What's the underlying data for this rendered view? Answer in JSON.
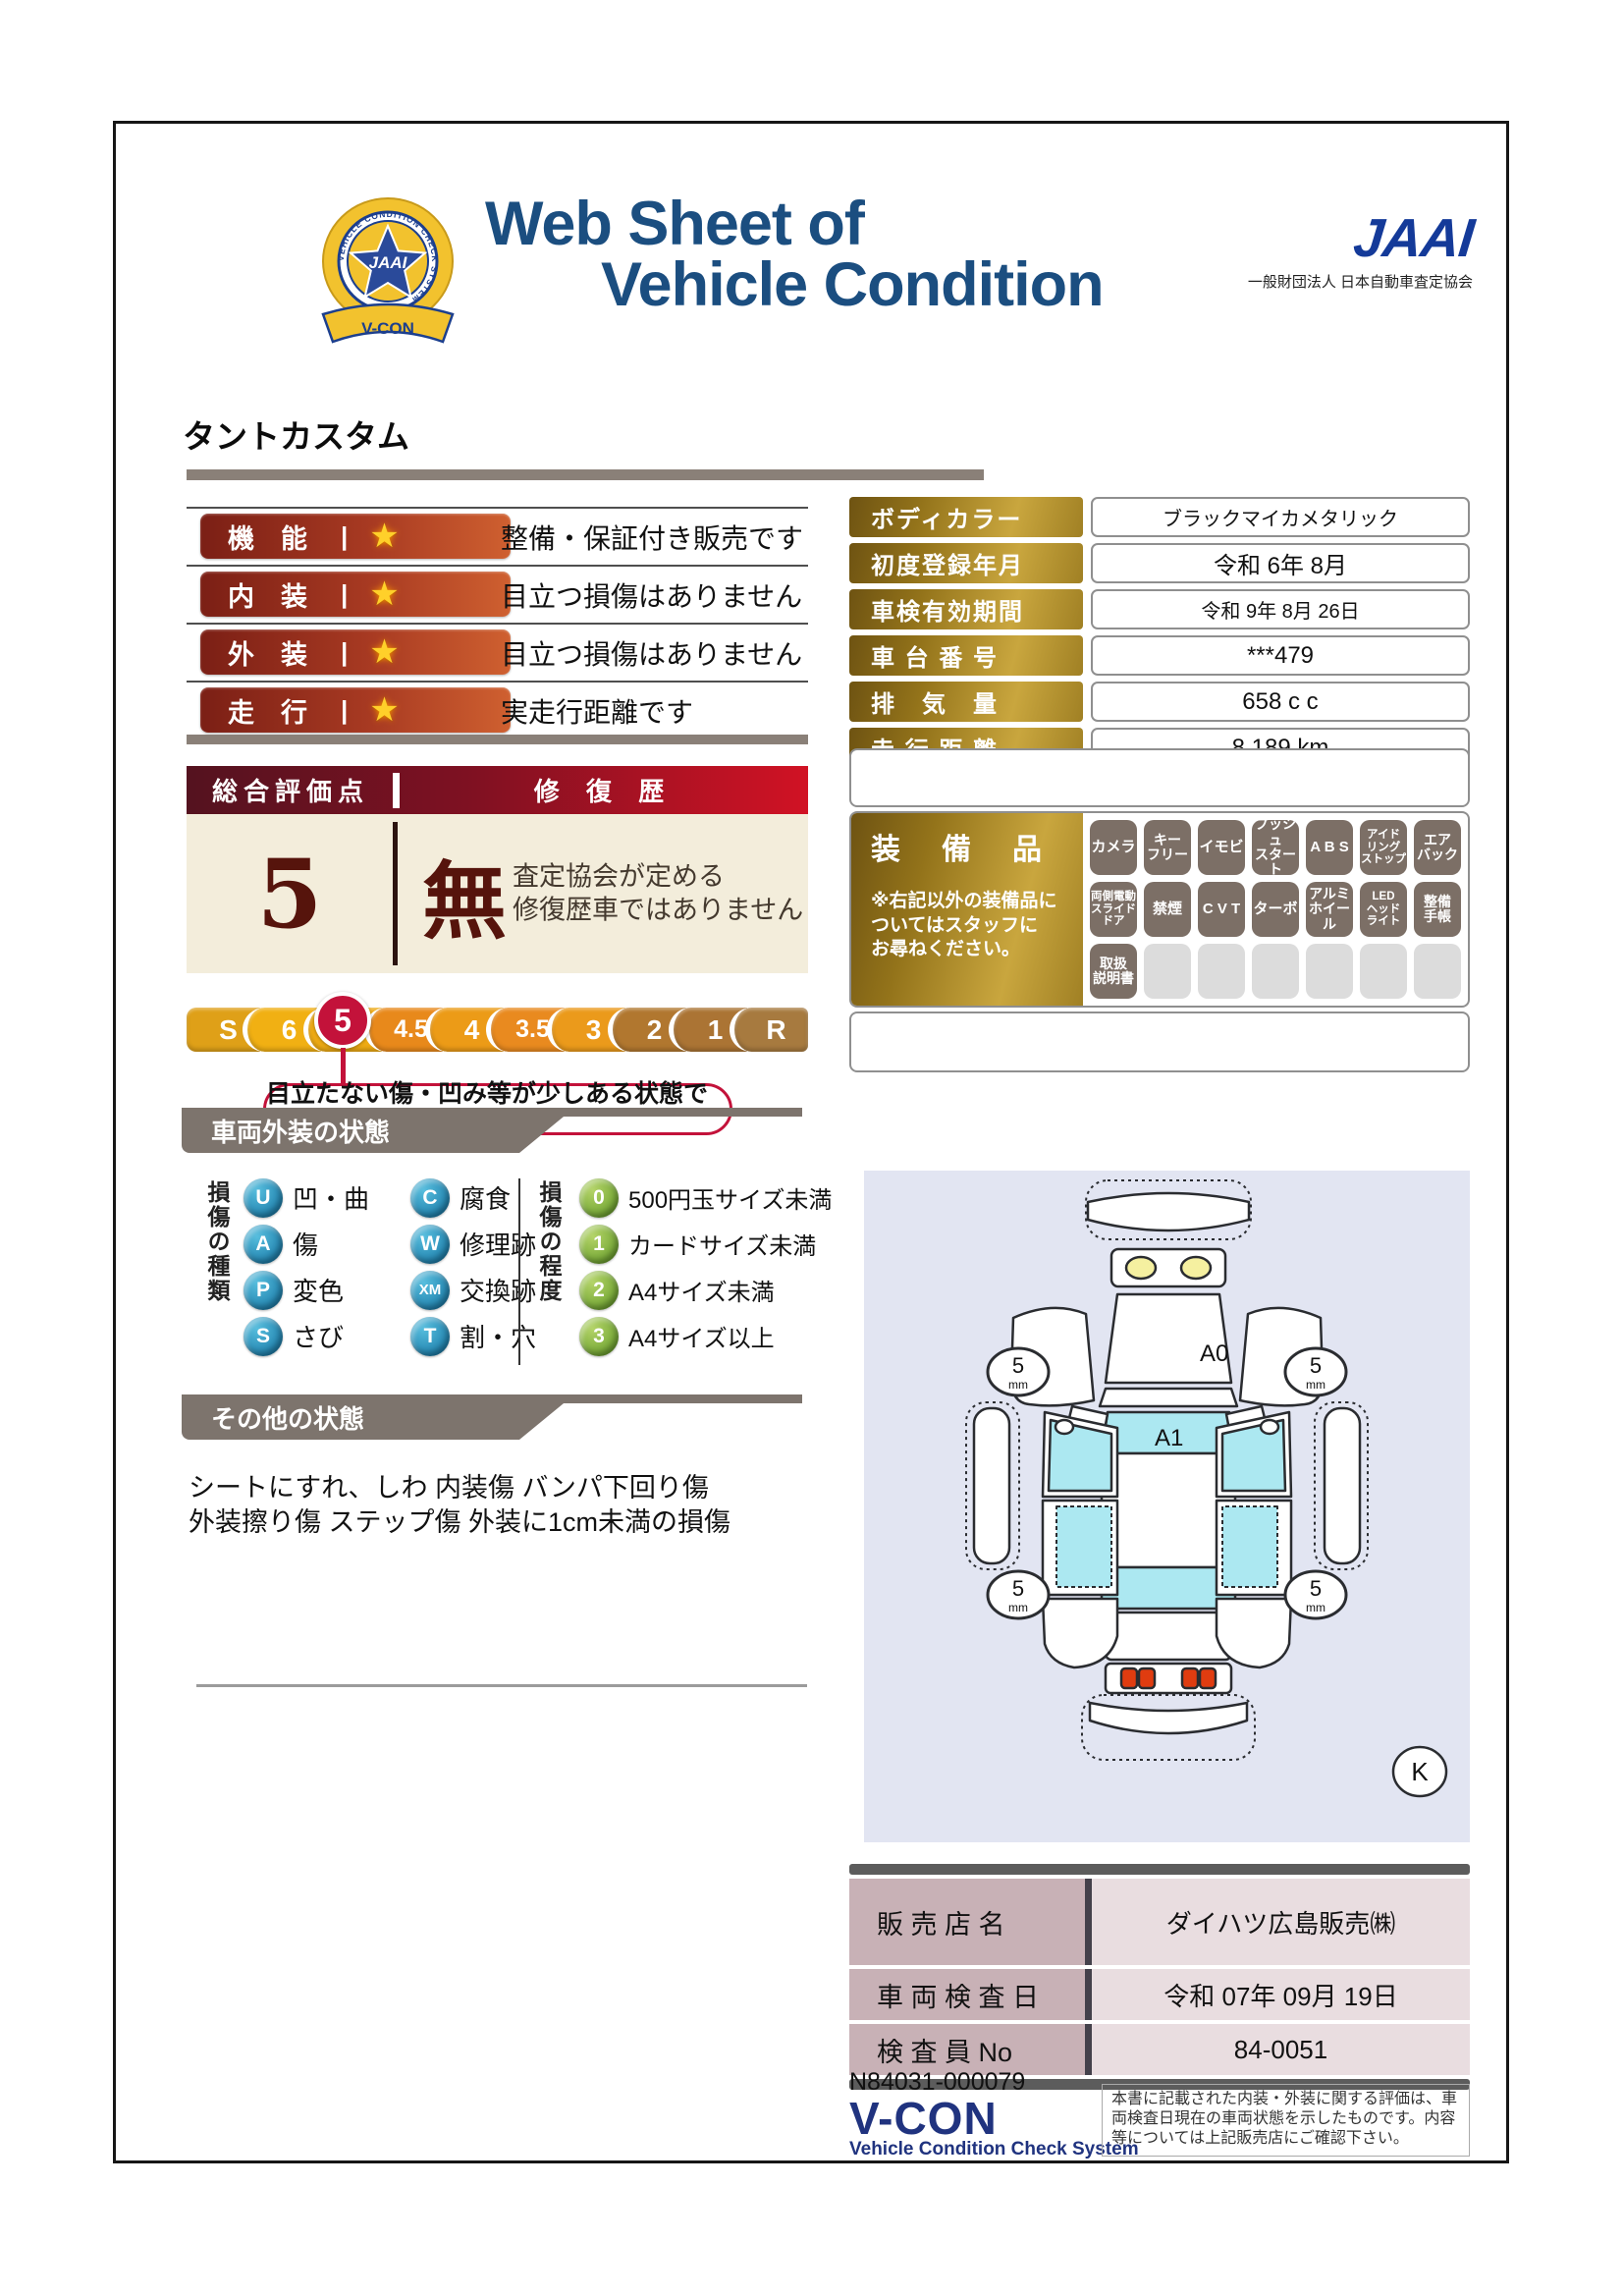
{
  "header": {
    "badge": {
      "org": "JAAI",
      "ribbon": "V-CON",
      "ring_text": "VEHICLE CONDITION CHECK SYSTEM"
    },
    "title_line1": "Web Sheet of",
    "title_line2": "Vehicle Condition",
    "jaai_logo": "JAAI",
    "jaai_subtitle": "一般財団法人 日本自動車査定協会"
  },
  "vehicle_name": "タントカスタム",
  "rating_separator": "|",
  "star": "★",
  "ratings": [
    {
      "label": "機　能",
      "comment": "整備・保証付き販売です"
    },
    {
      "label": "内　装",
      "comment": "目立つ損傷はありません"
    },
    {
      "label": "外　装",
      "comment": "目立つ損傷はありません"
    },
    {
      "label": "走　行",
      "comment": "実走行距離です"
    }
  ],
  "info_table": [
    {
      "label": "ボディカラー",
      "value": "ブラックマイカメタリック"
    },
    {
      "label": "初度登録年月",
      "value": "令和 6年 8月"
    },
    {
      "label": "車検有効期間",
      "value": "令和 9年 8月 26日"
    },
    {
      "label": "車 台 番 号",
      "value": "***479"
    },
    {
      "label": "排　気　量",
      "value": "658 c c"
    },
    {
      "label": "走 行 距 離",
      "value": "8,189 km"
    }
  ],
  "overall": {
    "header_left": "総合評価点",
    "header_right": "修 復 歴",
    "score": "5",
    "repair": "無",
    "repair_note1": "査定協会が定める",
    "repair_note2": "修復歴車ではありません"
  },
  "scale": {
    "segments": [
      {
        "label": "S",
        "color": "#dfa018"
      },
      {
        "label": "6",
        "color": "#f1b013"
      },
      {
        "label": "5",
        "color": "#eeab14",
        "selected": true
      },
      {
        "label": "4.5",
        "color": "#e8891b"
      },
      {
        "label": "4",
        "color": "#ec9b17"
      },
      {
        "label": "3.5",
        "color": "#e98a1f"
      },
      {
        "label": "3",
        "color": "#eb9a1b"
      },
      {
        "label": "2",
        "color": "#b1772f"
      },
      {
        "label": "1",
        "color": "#ab7434"
      },
      {
        "label": "R",
        "color": "#a77a3f"
      }
    ],
    "highlight_color": "#c3123a",
    "callout": "目立たない傷・凹み等が少しある状態です"
  },
  "equipment": {
    "title": "装　備　品",
    "note": "※右記以外の装備品に\nついてはスタッフに\nお尋ねください。",
    "items": [
      "カメラ",
      "キー\nフリー",
      "イモビ",
      "プッシュ\nスタート",
      "A B S",
      "アイド\nリング\nストップ",
      "エア\nバック",
      "両側電動\nスライド\nドア",
      "禁煙",
      "C V T",
      "ターボ",
      "アルミ\nホイール",
      "LED\nヘッド\nライト",
      "整備\n手帳",
      "取扱\n説明書"
    ],
    "empty_count": 6
  },
  "exterior_section": {
    "title": "車両外装の状態",
    "type_label": "損傷の種類",
    "types": [
      {
        "code": "U",
        "name": "凹・曲"
      },
      {
        "code": "C",
        "name": "腐食"
      },
      {
        "code": "A",
        "name": "傷"
      },
      {
        "code": "W",
        "name": "修理跡"
      },
      {
        "code": "P",
        "name": "変色"
      },
      {
        "code": "XM",
        "name": "交換跡"
      },
      {
        "code": "S",
        "name": "さび"
      },
      {
        "code": "T",
        "name": "割・穴"
      }
    ],
    "degree_label": "損傷の程度",
    "degrees": [
      {
        "code": "0",
        "name": "500円玉サイズ未満"
      },
      {
        "code": "1",
        "name": "カードサイズ未満"
      },
      {
        "code": "2",
        "name": "A4サイズ未満"
      },
      {
        "code": "3",
        "name": "A4サイズ以上"
      }
    ]
  },
  "other_section": {
    "title": "その他の状態",
    "line1": "シートにすれ、しわ 内装傷 バンパ下回り傷",
    "line2": "外装擦り傷 ステップ傷 外装に1cm未満の損傷"
  },
  "diagram": {
    "hood_label": "A0",
    "windshield_label": "A1",
    "tire_value": "5",
    "tire_unit": "mm",
    "key_label": "K"
  },
  "dealer_table": [
    {
      "label": "販 売 店 名",
      "value": "ダイハツ広島販売㈱"
    },
    {
      "label": "車 両 検 査 日",
      "value": "令和 07年 09月 19日"
    },
    {
      "label": "検 査 員 No",
      "value": "84-0051"
    }
  ],
  "footer": {
    "serial": "N84031-000079",
    "vcon": "V-CON",
    "vcon_sub": "Vehicle Condition Check System",
    "disclaimer": "本書に記載された内装・外装に関する評価は、車両検査日現在の車両状態を示したものです。内容等については上記販売店にご確認下さい。"
  },
  "colors": {
    "title_blue": "#1b4e80",
    "accent_red": "#d11224",
    "scale_highlight": "#c3123a",
    "gold": "#a08024",
    "diagram_bg": "#e2e5f2"
  }
}
